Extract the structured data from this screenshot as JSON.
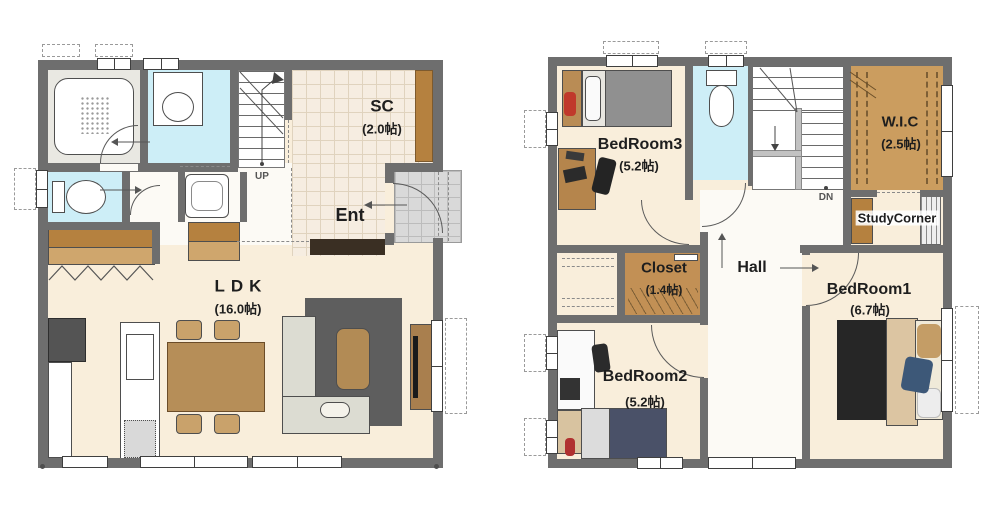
{
  "floor1": {
    "sc": {
      "name": "SC",
      "area": "(2.0帖)"
    },
    "ent": {
      "name": "Ent"
    },
    "ldk": {
      "name": "LDK",
      "area": "(16.0帖)"
    },
    "stairs": {
      "direction": "UP"
    }
  },
  "floor2": {
    "bedroom3": {
      "name": "BedRoom3",
      "area": "(5.2帖)"
    },
    "bedroom2": {
      "name": "BedRoom2",
      "area": "(5.2帖)"
    },
    "bedroom1": {
      "name": "BedRoom1",
      "area": "(6.7帖)"
    },
    "wic": {
      "name": "W.I.C",
      "area": "(2.5帖)"
    },
    "closet": {
      "name": "Closet",
      "area": "(1.4帖)"
    },
    "hall": {
      "name": "Hall"
    },
    "study_corner": {
      "name": "StudyCorner"
    },
    "stairs": {
      "direction": "DN"
    }
  },
  "colors": {
    "wall": "#6e6e6e",
    "wood_floor": "#f9eedb",
    "tile_floor": "#f6ede1",
    "wet_floor": "#cdeef7",
    "closet_floor": "#b5813f",
    "wic_floor": "#cb9d5f",
    "porch": "#d9d9d9",
    "label": "#1e1e1e"
  }
}
